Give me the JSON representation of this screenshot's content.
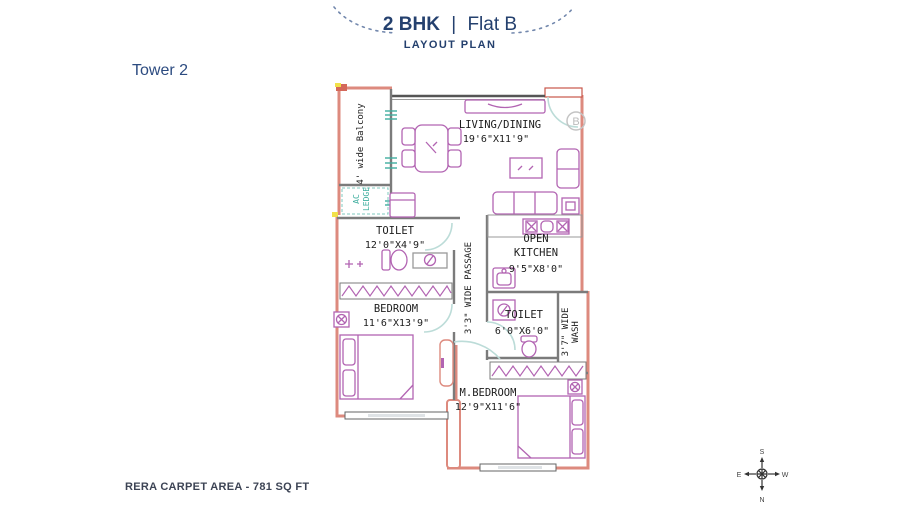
{
  "header": {
    "title_bold": "2 BHK",
    "title_divider": "|",
    "title_regular": "Flat B",
    "subtitle": "LAYOUT PLAN"
  },
  "tower": {
    "label": "Tower 2"
  },
  "plan": {
    "living": {
      "name": "LIVING/DINING",
      "dims": "19'6\"X11'9\""
    },
    "balcony": {
      "label": "4' wide  Balcony"
    },
    "ac_ledge": {
      "line1": "AC",
      "line2": "LEDGE"
    },
    "toilet_common": {
      "name": "TOILET",
      "dims": "12'0\"X4'9\""
    },
    "passage": {
      "label": "3'3\" WIDE PASSAGE"
    },
    "kitchen": {
      "line1": "OPEN",
      "line2": "KITCHEN",
      "dims": "9'5\"X8'0\""
    },
    "toilet_master": {
      "name": "TOILET",
      "dims": "6'0\"X6'0\""
    },
    "wash": {
      "line1": "3'7\" WIDE",
      "line2": "WASH"
    },
    "bedroom": {
      "name": "BEDROOM",
      "dims": "11'6\"X13'9\""
    },
    "master_bedroom": {
      "name": "M.BEDROOM",
      "dims": "12'9\"X11'6\""
    },
    "entry_marker": "B"
  },
  "compass": {
    "top": "S",
    "bottom": "N",
    "left": "E",
    "right": "W"
  },
  "footer": {
    "carpet_area": "RERA CARPET AREA - 781 SQ FT"
  },
  "colors": {
    "navy": "#24406e",
    "wall_outer": "#dd8a7e",
    "wall_accent": "#c9564a",
    "furniture": "#b264b2",
    "teal": "#3fae9f",
    "ink": "#1c1c1c",
    "door_arc": "#bcdcd8"
  }
}
